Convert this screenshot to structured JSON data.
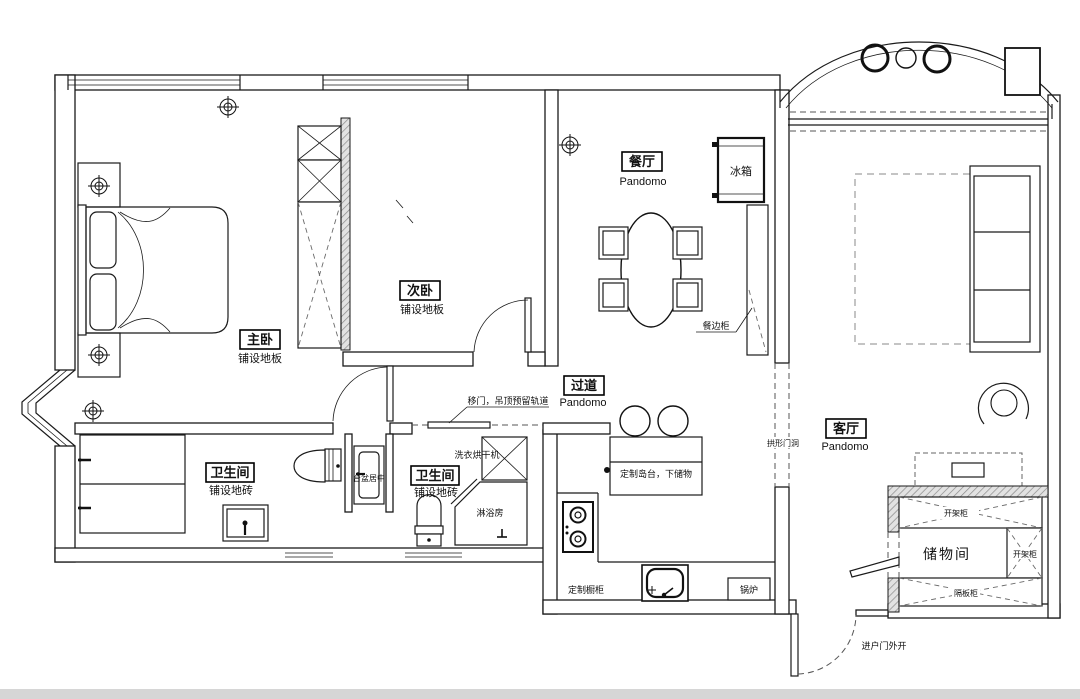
{
  "rooms": {
    "master_bedroom": {
      "name": "主卧",
      "floor": "铺设地板"
    },
    "second_bedroom": {
      "name": "次卧",
      "floor": "铺设地板"
    },
    "dining": {
      "name": "餐厅",
      "floor": "Pandomo"
    },
    "hallway": {
      "name": "过道",
      "floor": "Pandomo"
    },
    "living": {
      "name": "客厅",
      "floor": "Pandomo"
    },
    "bathroom_left": {
      "name": "卫生间",
      "floor": "铺设地砖"
    },
    "bathroom_mid": {
      "name": "卫生间",
      "floor": "铺设地砖"
    },
    "storage": {
      "name": "储物间"
    }
  },
  "fixtures": {
    "fridge": "冰箱",
    "sideboard": "餐边柜",
    "arch_opening": "拱形门洞",
    "sliding_door": "移门，吊顶预留轨道",
    "washer_dryer": "洗衣烘干机",
    "sink_centered": "台盆居中",
    "shower": "淋浴房",
    "island": "定制岛台，下储物",
    "custom_cabinet": "定制橱柜",
    "boiler": "锅炉",
    "open_shelf_top": "开架柜",
    "open_shelf_right": "开架柜",
    "shelf_cabinet": "隔板柜",
    "entry_door": "进户门外开"
  }
}
